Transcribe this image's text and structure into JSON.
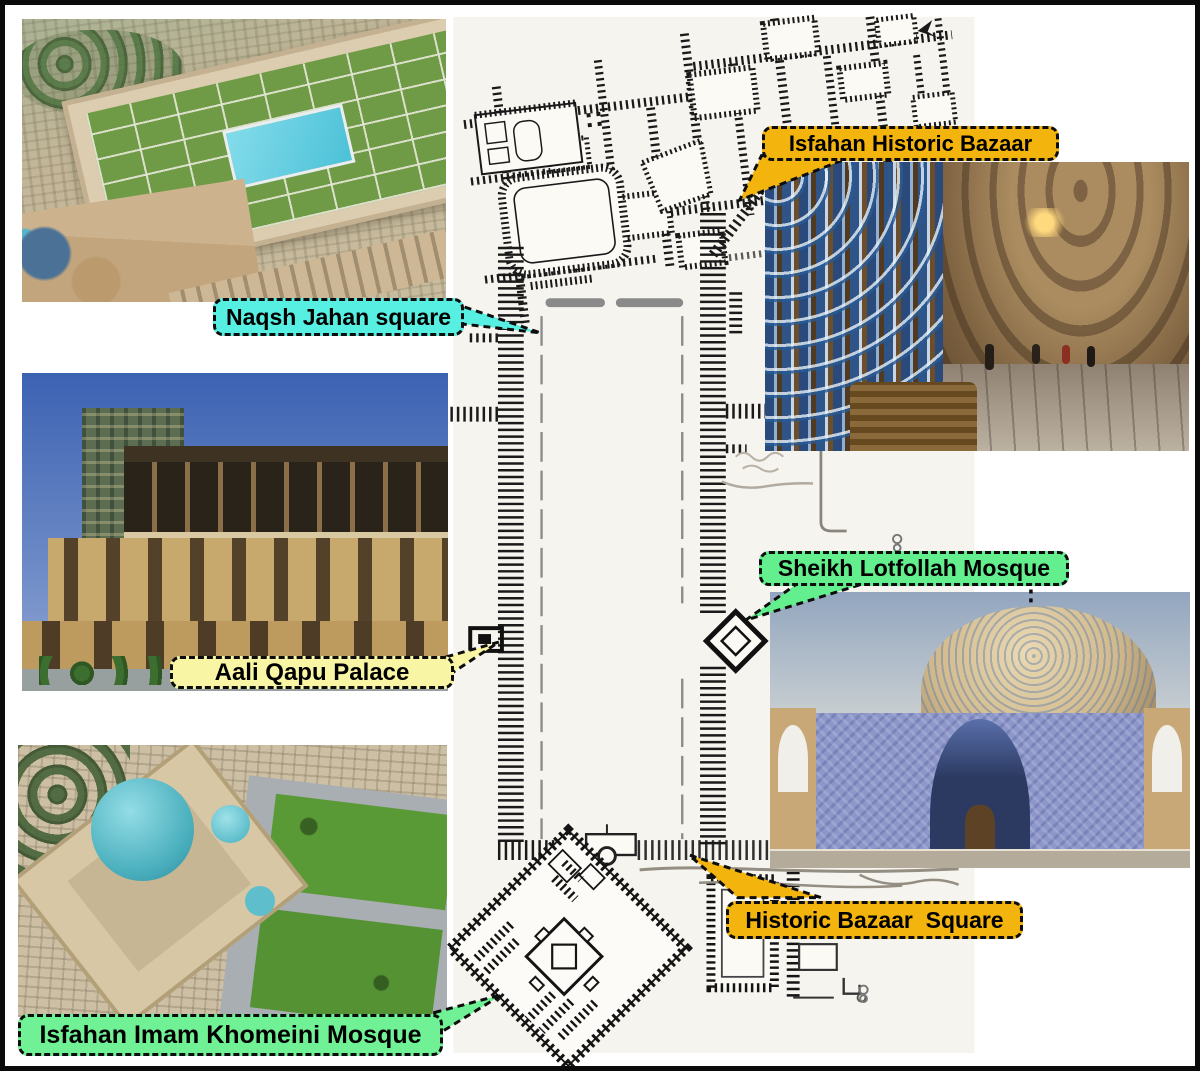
{
  "figure": {
    "name": "naqsh-jahan-square-isfahan-annotated-plan",
    "border_color": "#0a0a0a",
    "background": "#ffffff"
  },
  "plan": {
    "paper": "#f6f4ee",
    "ink": "#1a1a1a",
    "features": [
      "bazaar-network",
      "naqsh-jahan-square",
      "aali-qapu-palace",
      "sheikh-lotfollah-mosque",
      "imam-mosque",
      "historic-bazaar-square"
    ]
  },
  "callouts": {
    "naqsh": {
      "text": "Naqsh Jahan square",
      "bg": "#57efe2"
    },
    "bazaar": {
      "text": "Isfahan Historic Bazaar",
      "bg": "#f3b40e"
    },
    "aali": {
      "text": "Aali Qapu Palace",
      "bg": "#f8f6a4"
    },
    "lotfollah": {
      "text": "Sheikh Lotfollah Mosque",
      "bg": "#63ef8e"
    },
    "bazaar_square": {
      "text": "Historic Bazaar  Square",
      "bg": "#f3b40e"
    },
    "imam": {
      "text": "Isfahan Imam Khomeini Mosque",
      "bg": "#70f195"
    }
  },
  "photos": {
    "naqsh_aerial": "aerial-view-naqsh-jahan-square",
    "bazaar_interior": "isfahan-historic-bazaar-interior",
    "aali_qapu": "aali-qapu-palace-facade",
    "imam_aerial": "aerial-view-imam-khomeini-mosque",
    "lotfollah": "sheikh-lotfollah-mosque-facade"
  }
}
